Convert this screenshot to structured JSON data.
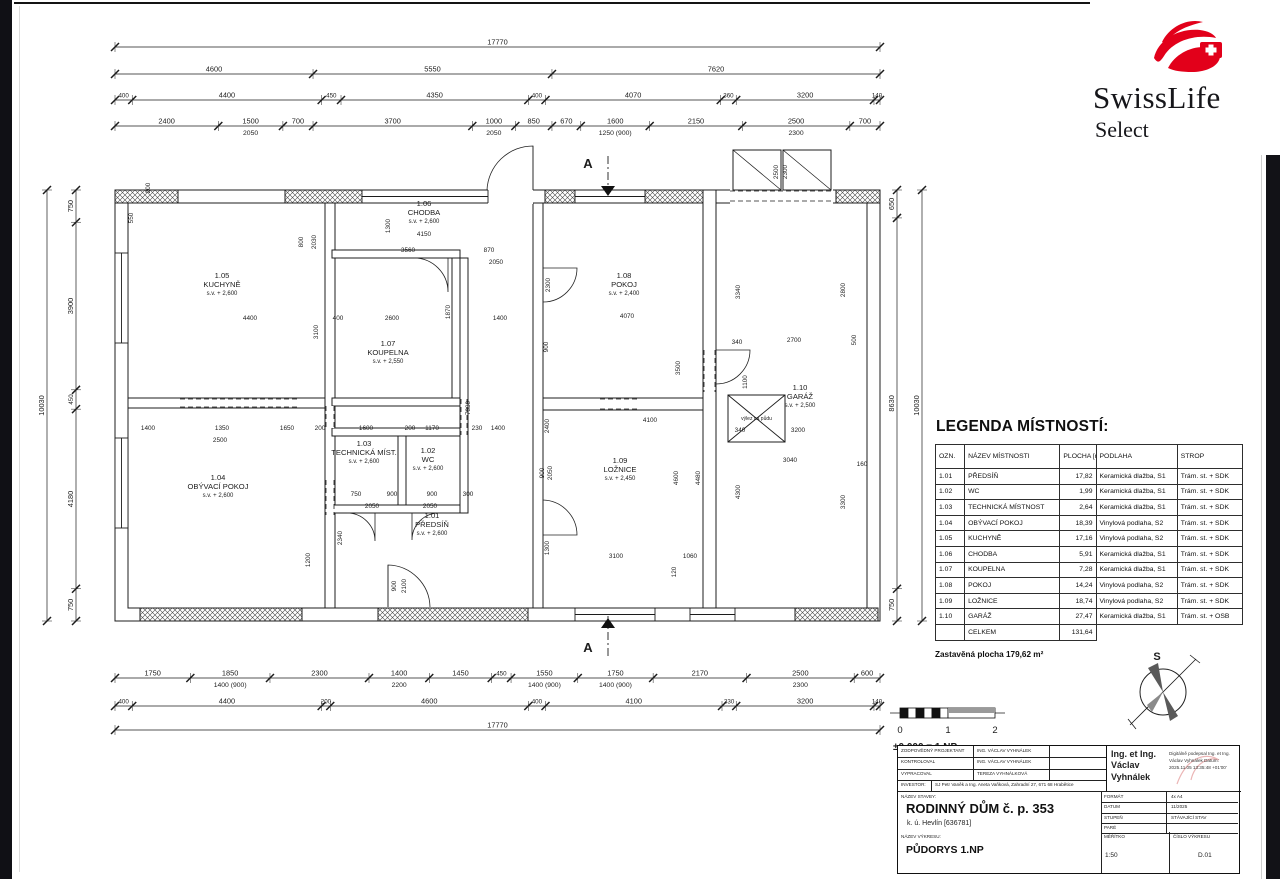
{
  "logo": {
    "brand": "SwissLife",
    "sub": "Select",
    "red": "#e2001a"
  },
  "legend": {
    "title": "LEGENDA MÍSTNOSTÍ:",
    "headers": [
      "OZN.",
      "NÁZEV MÍSTNOSTI",
      "PLOCHA [m²]",
      "PODLAHA",
      "STROP"
    ],
    "rows": [
      [
        "1.01",
        "PŘEDSÍŇ",
        "17,82",
        "Keramická dlažba, S1",
        "Trám. st. + SDK"
      ],
      [
        "1.02",
        "WC",
        "1,99",
        "Keramická dlažba, S1",
        "Trám. st. + SDK"
      ],
      [
        "1.03",
        "TECHNICKÁ MÍSTNOST",
        "2,64",
        "Keramická dlažba, S1",
        "Trám. st. + SDK"
      ],
      [
        "1.04",
        "OBÝVACÍ POKOJ",
        "18,39",
        "Vinylová podlaha, S2",
        "Trám. st. + SDK"
      ],
      [
        "1.05",
        "KUCHYNĚ",
        "17,16",
        "Vinylová podlaha, S2",
        "Trám. st. + SDK"
      ],
      [
        "1.06",
        "CHODBA",
        "5,91",
        "Keramická dlažba, S1",
        "Trám. st. + SDK"
      ],
      [
        "1.07",
        "KOUPELNA",
        "7,28",
        "Keramická dlažba, S1",
        "Trám. st. + SDK"
      ],
      [
        "1.08",
        "POKOJ",
        "14,24",
        "Vinylová podlaha, S2",
        "Trám. st. + SDK"
      ],
      [
        "1.09",
        "LOŽNICE",
        "18,74",
        "Vinylová podlaha, S2",
        "Trám. st. + SDK"
      ],
      [
        "1.10",
        "GARÁŽ",
        "27,47",
        "Keramická dlažba, S1",
        "Trám. st. + OSB"
      ]
    ],
    "total_label": "CELKEM",
    "total_value": "131,64",
    "footer": "Zastavěná plocha 179,62 m²"
  },
  "titleblock": {
    "rows": [
      {
        "label": "ZODPOVĚDNÝ PROJEKTANT",
        "value": "ING. VÁCLAV VYHNÁLEK"
      },
      {
        "label": "KONTROLOVAL",
        "value": "ING. VÁCLAV VYHNÁLEK"
      },
      {
        "label": "VYPRACOVAL",
        "value": "TEREZA VYHNÁLKOVÁ"
      },
      {
        "label": "INVESTOR:",
        "value": "SJ Petr Vaněk a Ing. Aneta Vaňková, Zahradní 27, 671 68 Hrabětice"
      }
    ],
    "signature": {
      "name": "Ing. et Ing. Václav Vyhnálek",
      "note": "Digitálně podepsal Ing. et Ing. Václav Vyhnálek Datum: 2025.11.05 13:35:48 +01'00'"
    },
    "nazev_stavby_label": "NÁZEV STAVBY:",
    "stavba": "RODINNÝ DŮM č. p. 353",
    "stavba_sub": "k. ú. Hevlín [636781]",
    "nazev_vykresu_label": "NÁZEV VÝKRESU:",
    "vykres": "PŮDORYS 1.NP",
    "format_label": "FORMÁT",
    "format": "4x A4",
    "datum_label": "DATUM",
    "datum": "11/2025",
    "stupen_label": "STUPEŇ",
    "stupen": "STÁVAJÍCÍ STAV",
    "pare_label": "PARÉ",
    "pare": "",
    "meritko_label": "MĚŘÍTKO",
    "meritko": "1:50",
    "cislo_label": "ČÍSLO VÝKRESU",
    "cislo": "D.01"
  },
  "scalebar": {
    "labels": [
      "0",
      "1",
      "2"
    ],
    "note": "±0,000 = 1.NP"
  },
  "compass": {
    "label": "S"
  },
  "section": {
    "label": "A"
  },
  "plan": {
    "attic_label": "výlez na půdu",
    "top_chains": [
      {
        "y": 47,
        "vals": [
          "17770"
        ]
      },
      {
        "y": 74,
        "vals": [
          "4600",
          "5550",
          "7620"
        ]
      },
      {
        "y": 100,
        "vals": [
          "400",
          "4400",
          "450",
          "4350",
          "400",
          "4070",
          "360",
          "3200",
          "140"
        ]
      },
      {
        "y": 126,
        "vals": [
          {
            "v": "2400"
          },
          {
            "v": "1500",
            "sub": "2050"
          },
          {
            "v": "700"
          },
          {
            "v": "3700"
          },
          {
            "v": "1000",
            "sub": "2050"
          },
          {
            "v": "850"
          },
          {
            "v": "670"
          },
          {
            "v": "1600",
            "sub": "1250 (900)"
          },
          {
            "v": "2150"
          },
          {
            "v": "2500",
            "sub": "2300"
          },
          {
            "v": "700"
          }
        ]
      }
    ],
    "bottom_chains": [
      {
        "y": 678,
        "vals": [
          {
            "v": "1750"
          },
          {
            "v": "1850",
            "sub": "1400 (900)"
          },
          {
            "v": "2300"
          },
          {
            "v": "1400",
            "sub": "2200"
          },
          {
            "v": "1450"
          },
          {
            "v": "450"
          },
          {
            "v": "1550",
            "sub": "1400 (900)"
          },
          {
            "v": "1750",
            "sub": "1400 (900)"
          },
          {
            "v": "2170"
          },
          {
            "v": "2500",
            "sub": "2300"
          },
          {
            "v": "600"
          }
        ]
      },
      {
        "y": 706,
        "vals": [
          "400",
          "4400",
          "200",
          "4600",
          "400",
          "4100",
          "330",
          "3200",
          "140"
        ]
      },
      {
        "y": 730,
        "vals": [
          "17770"
        ]
      }
    ],
    "left_chains": [
      {
        "x": 47,
        "vals": [
          "10030"
        ]
      },
      {
        "x": 76,
        "vals": [
          "750",
          "3900",
          "450",
          "4180",
          "750"
        ]
      }
    ],
    "right_chains": [
      {
        "x": 897,
        "vals": [
          "650",
          "8630",
          "750"
        ]
      },
      {
        "x": 922,
        "vals": [
          "10030"
        ]
      }
    ],
    "rooms": [
      {
        "num": "1.05",
        "name": "KUCHYNĚ",
        "sv": "s.v. + 2,600",
        "x": 222,
        "y": 278
      },
      {
        "num": "1.04",
        "name": "OBÝVACÍ POKOJ",
        "sv": "s.v. + 2,600",
        "x": 218,
        "y": 480
      },
      {
        "num": "1.03",
        "name": "TECHNICKÁ MÍST.",
        "sv": "s.v. + 2,600",
        "x": 364,
        "y": 446
      },
      {
        "num": "1.02",
        "name": "WC",
        "sv": "s.v. + 2,600",
        "x": 428,
        "y": 453
      },
      {
        "num": "1.01",
        "name": "PŘEDSÍŇ",
        "sv": "s.v. + 2,600",
        "x": 432,
        "y": 518
      },
      {
        "num": "1.06",
        "name": "CHODBA",
        "sv": "s.v. + 2,600",
        "x": 424,
        "y": 206
      },
      {
        "num": "1.07",
        "name": "KOUPELNA",
        "sv": "s.v. + 2,550",
        "x": 388,
        "y": 346
      },
      {
        "num": "1.08",
        "name": "POKOJ",
        "sv": "s.v. + 2,400",
        "x": 624,
        "y": 278
      },
      {
        "num": "1.09",
        "name": "LOŽNICE",
        "sv": "s.v. + 2,450",
        "x": 620,
        "y": 463
      },
      {
        "num": "1.10",
        "name": "GARÁŽ",
        "sv": "s.v. + 2,500",
        "x": 800,
        "y": 390
      }
    ],
    "inner_dims": [
      [
        "4150",
        424,
        236,
        0
      ],
      [
        "3560",
        408,
        252,
        0
      ],
      [
        "870",
        489,
        252,
        0
      ],
      [
        "2050",
        496,
        264,
        0
      ],
      [
        "4400",
        250,
        320,
        0
      ],
      [
        "400",
        338,
        320,
        0
      ],
      [
        "2600",
        392,
        320,
        0
      ],
      [
        "1400",
        500,
        320,
        0
      ],
      [
        "3100",
        318,
        332,
        1
      ],
      [
        "1870",
        450,
        312,
        1
      ],
      [
        "2300",
        550,
        285,
        1
      ],
      [
        "4070",
        627,
        318,
        0
      ],
      [
        "3500",
        680,
        368,
        1
      ],
      [
        "900",
        548,
        347,
        1
      ],
      [
        "1400",
        148,
        430,
        0
      ],
      [
        "1350",
        222,
        430,
        0
      ],
      [
        "2500",
        220,
        442,
        0
      ],
      [
        "1650",
        287,
        430,
        0
      ],
      [
        "200",
        320,
        430,
        0
      ],
      [
        "1600",
        366,
        430,
        0
      ],
      [
        "200",
        410,
        430,
        0
      ],
      [
        "1170",
        432,
        430,
        0
      ],
      [
        "230",
        477,
        430,
        0
      ],
      [
        "1400",
        498,
        430,
        0
      ],
      [
        "7330",
        470,
        408,
        1
      ],
      [
        "750",
        356,
        496,
        0
      ],
      [
        "900",
        392,
        496,
        0
      ],
      [
        "2050",
        372,
        508,
        0
      ],
      [
        "900",
        432,
        496,
        0
      ],
      [
        "300",
        468,
        496,
        0
      ],
      [
        "2050",
        430,
        508,
        0
      ],
      [
        "2340",
        342,
        538,
        1
      ],
      [
        "1200",
        310,
        560,
        1
      ],
      [
        "4100",
        650,
        422,
        0
      ],
      [
        "2400",
        549,
        426,
        1
      ],
      [
        "4600",
        678,
        478,
        1
      ],
      [
        "4480",
        700,
        478,
        1
      ],
      [
        "900",
        544,
        473,
        1
      ],
      [
        "2050",
        552,
        473,
        1
      ],
      [
        "1300",
        549,
        548,
        1
      ],
      [
        "3100",
        616,
        558,
        0
      ],
      [
        "1060",
        690,
        558,
        0
      ],
      [
        "120",
        676,
        572,
        1
      ],
      [
        "340",
        737,
        344,
        0
      ],
      [
        "2700",
        794,
        342,
        0
      ],
      [
        "500",
        856,
        340,
        1
      ],
      [
        "3340",
        740,
        292,
        1
      ],
      [
        "2800",
        845,
        290,
        1
      ],
      [
        "1100",
        747,
        382,
        1
      ],
      [
        "340",
        740,
        432,
        0
      ],
      [
        "3200",
        798,
        432,
        0
      ],
      [
        "3040",
        790,
        462,
        0
      ],
      [
        "160",
        862,
        466,
        0
      ],
      [
        "4300",
        740,
        492,
        1
      ],
      [
        "3300",
        845,
        502,
        1
      ],
      [
        "550",
        133,
        218,
        1
      ],
      [
        "200",
        150,
        188,
        1
      ],
      [
        "800",
        303,
        242,
        1
      ],
      [
        "2030",
        316,
        242,
        1
      ],
      [
        "1300",
        390,
        226,
        1
      ],
      [
        "2500",
        778,
        172,
        1
      ],
      [
        "2300",
        787,
        172,
        1
      ],
      [
        "900",
        396,
        586,
        1
      ],
      [
        "2100",
        406,
        586,
        1
      ]
    ]
  }
}
